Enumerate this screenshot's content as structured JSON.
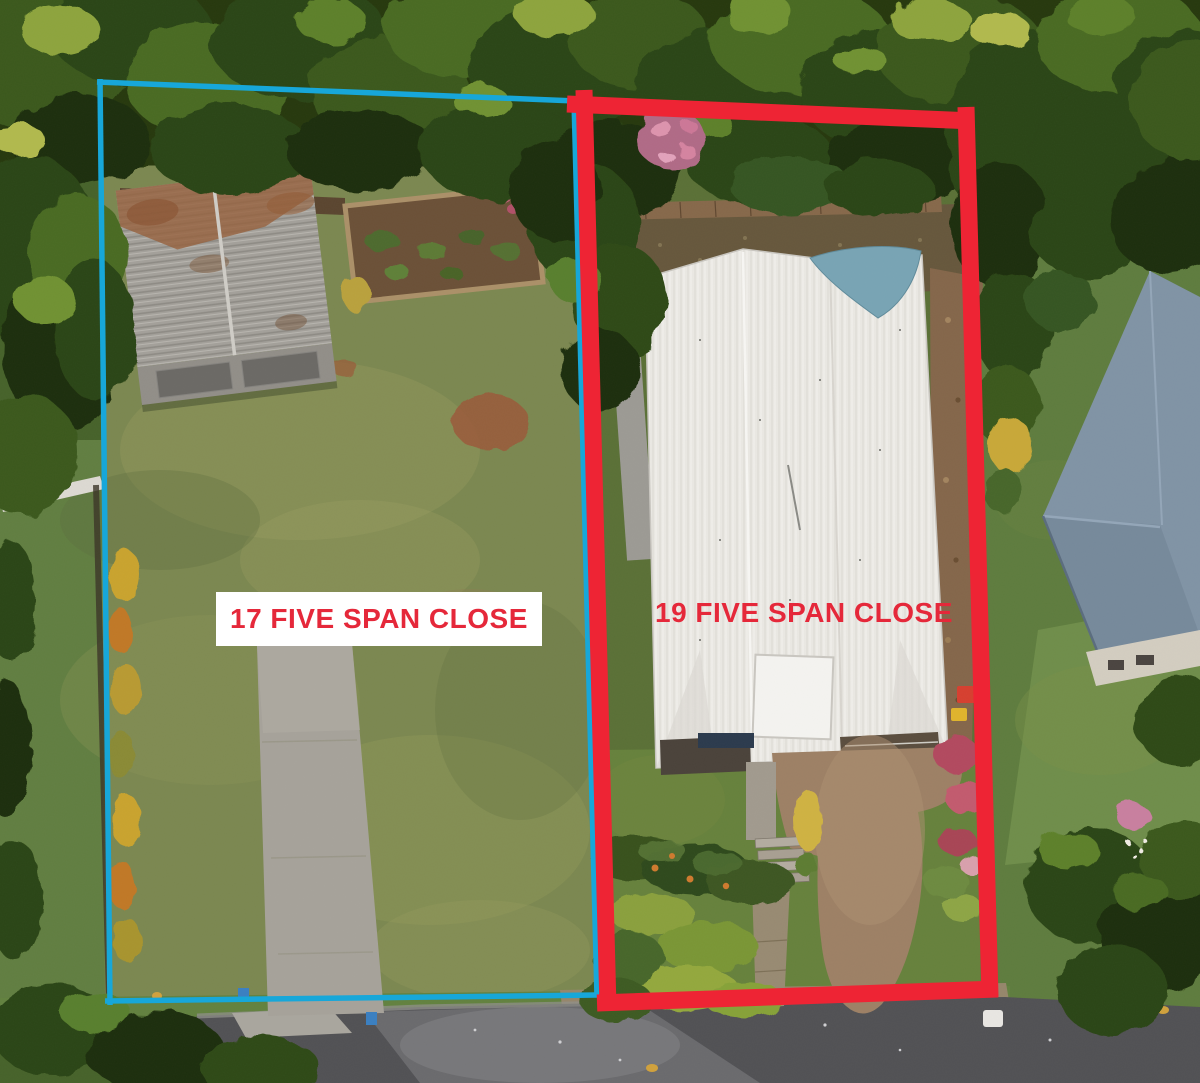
{
  "labels": {
    "lot17": "17 FIVE SPAN CLOSE",
    "lot19": "19 FIVE SPAN CLOSE"
  },
  "colors": {
    "lot17_outline": "#17a7d9",
    "lot19_outline": "#ee2434",
    "label_text": "#e5283a",
    "label17_bg": "#ffffff"
  }
}
